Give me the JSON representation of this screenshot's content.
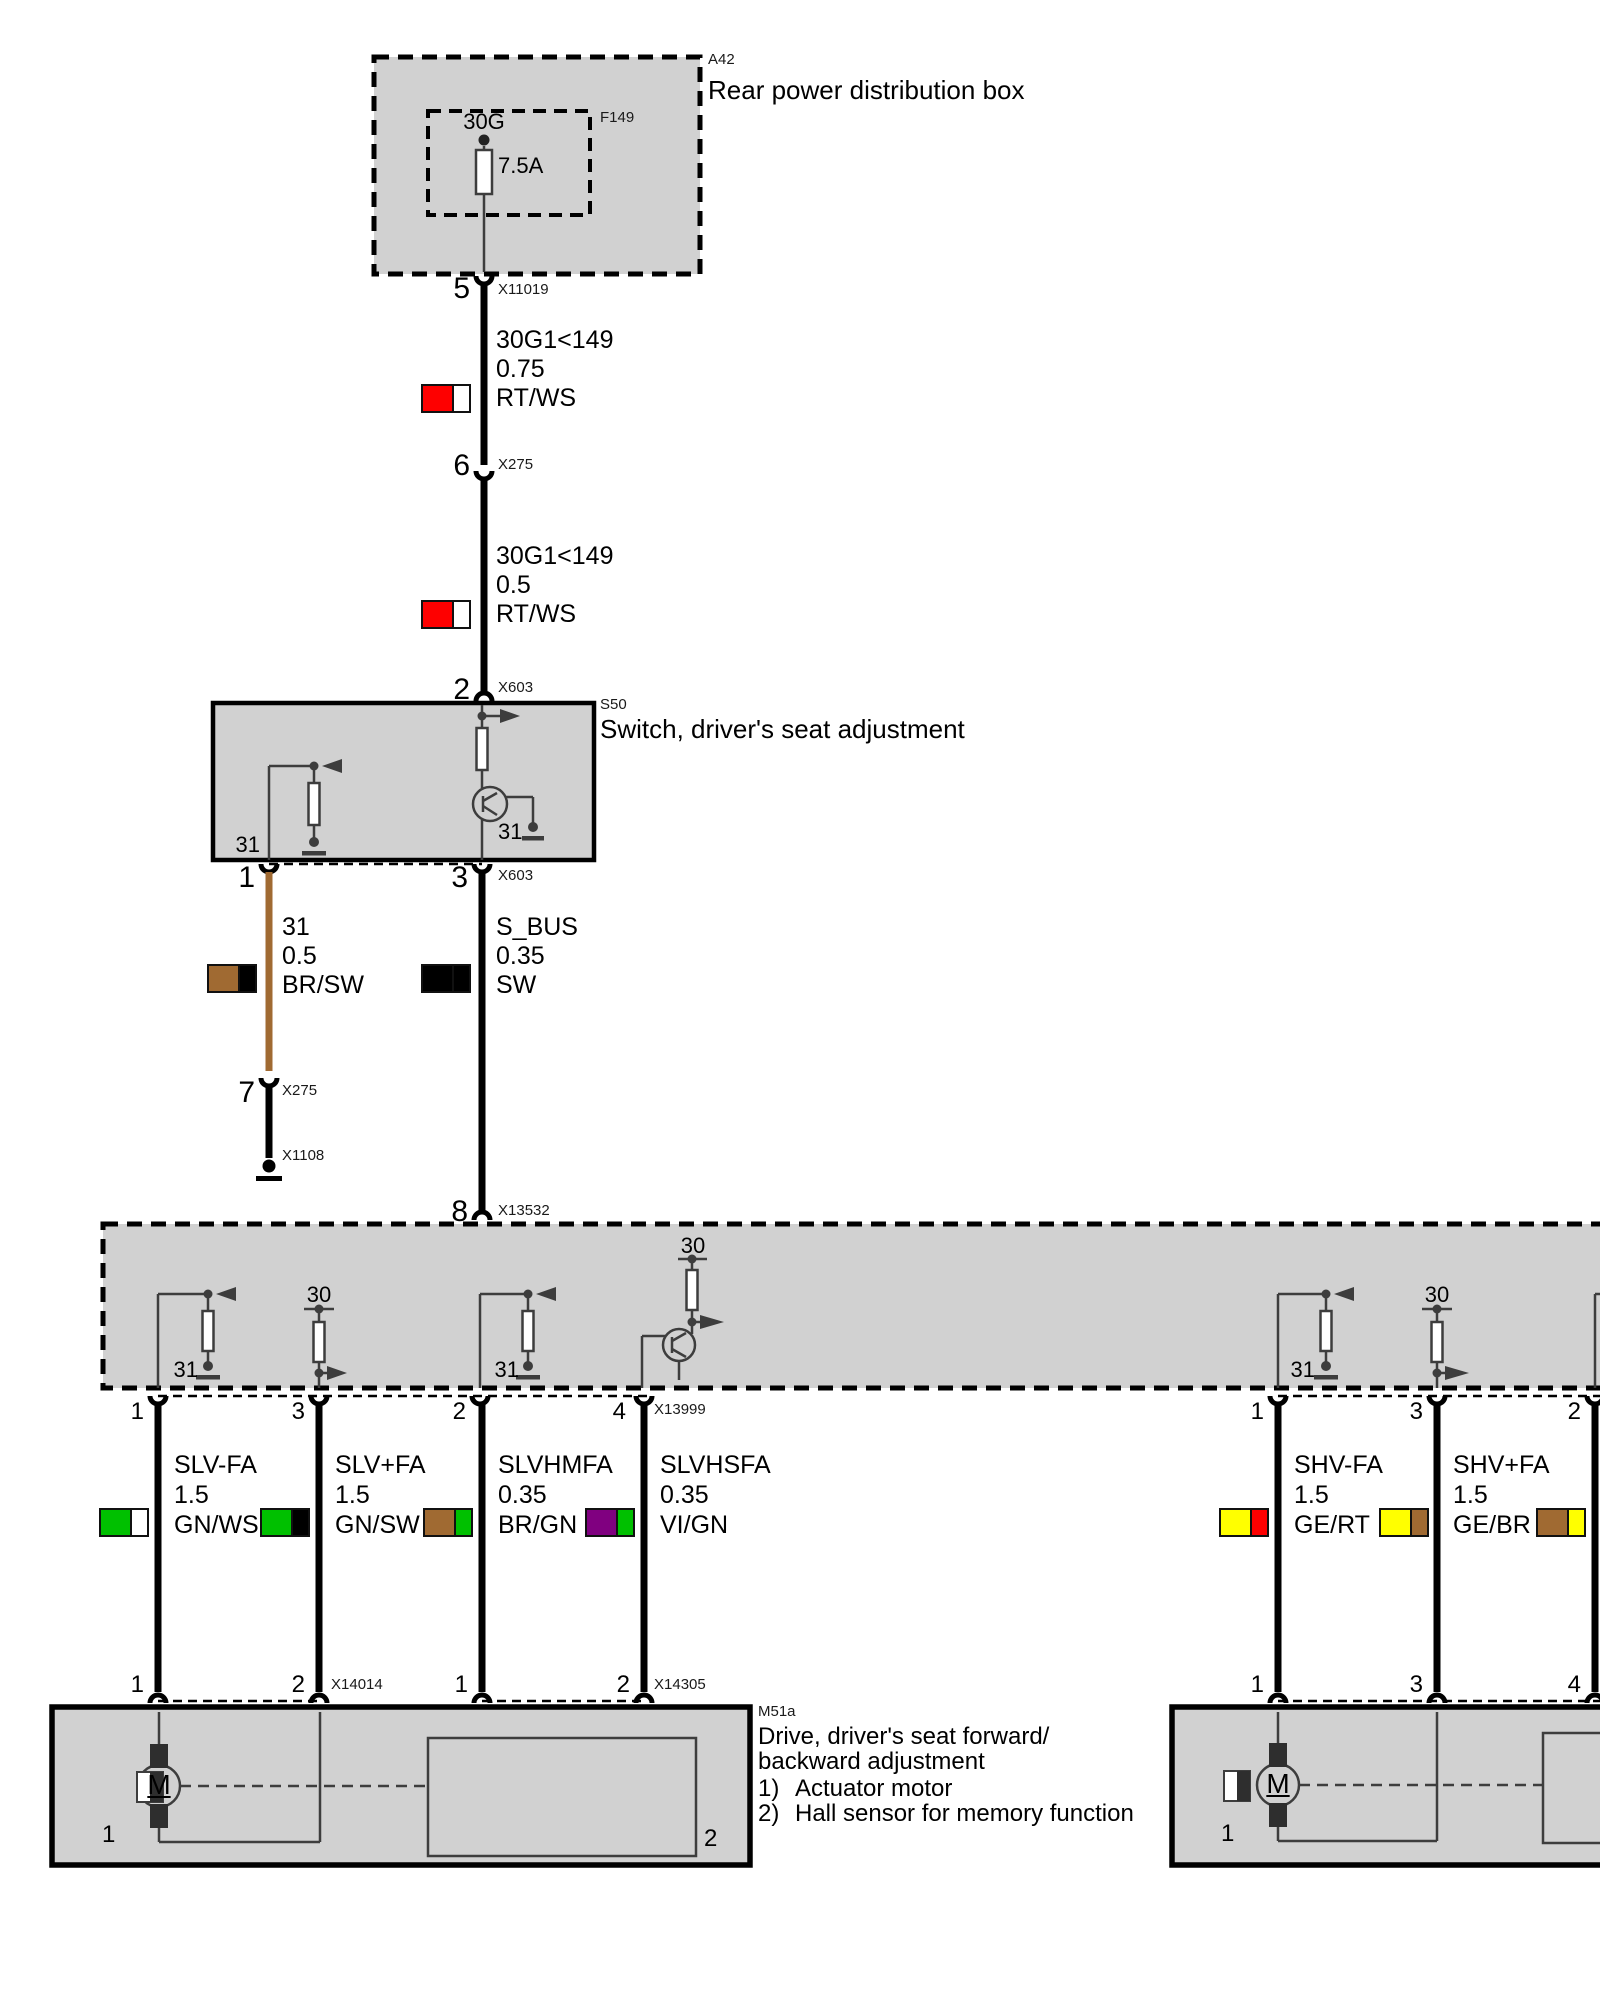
{
  "colors": {
    "box_fill": "#d1d1d1",
    "line_dark": "#3d3d3d",
    "wire_black": "#000000",
    "wire_brown": "#a06a32",
    "red": "#fe0000",
    "white": "#ffffff",
    "green": "#00c000",
    "violet": "#800080",
    "yellow": "#ffff00",
    "black": "#000000"
  },
  "components": {
    "a42": {
      "id": "A42",
      "label": "Rear power distribution box"
    },
    "f149": {
      "id": "F149",
      "fuse_name": "30G",
      "fuse_rating": "7.5A"
    },
    "s50": {
      "id": "S50",
      "label": "Switch, driver's seat adjustment"
    },
    "m51a": {
      "id": "M51a",
      "label_line1": "Drive, driver's seat forward/",
      "label_line2": "backward adjustment",
      "note1_num": "1)",
      "note1_text": "Actuator motor",
      "note2_num": "2)",
      "note2_text": "Hall sensor for memory function"
    },
    "motor_symbol": "M"
  },
  "connectors": {
    "x11019": "X11019",
    "x275": "X275",
    "x603": "X603",
    "x1108": "X1108",
    "x13532": "X13532",
    "x13999": "X13999",
    "x14014": "X14014",
    "x14305": "X14305"
  },
  "internal_labels": {
    "ground": "31",
    "power": "30"
  },
  "pins": {
    "p5": "5",
    "p6": "6",
    "p2": "2",
    "s50_p1": "1",
    "s50_p3": "3",
    "p7": "7",
    "p8": "8",
    "mod_p1": "1",
    "mod_p3": "3",
    "mod_p2": "2",
    "mod_p4": "4",
    "mod_r1": "1",
    "mod_r3": "3",
    "mod_r2": "2",
    "bot_p1": "1",
    "bot_p2": "2",
    "bot_b1": "1",
    "bot_b2": "2",
    "botr_1": "1",
    "botr_3": "3",
    "botr_4": "4",
    "inner_motor": "1",
    "inner_hall": "2",
    "innerR_motor": "1"
  },
  "wires": [
    {
      "circuit": "30G1<149",
      "gauge": "0.75",
      "color": "RT/WS",
      "swatch": [
        "#fe0000",
        "#ffffff"
      ]
    },
    {
      "circuit": "30G1<149",
      "gauge": "0.5",
      "color": "RT/WS",
      "swatch": [
        "#fe0000",
        "#ffffff"
      ]
    },
    {
      "circuit": "31",
      "gauge": "0.5",
      "color": "BR/SW",
      "swatch": [
        "#a06a32",
        "#000000"
      ]
    },
    {
      "circuit": "S_BUS",
      "gauge": "0.35",
      "color": "SW",
      "swatch": [
        "#000000",
        "#000000"
      ]
    },
    {
      "circuit": "SLV-FA",
      "gauge": "1.5",
      "color": "GN/WS",
      "swatch": [
        "#00c000",
        "#ffffff"
      ]
    },
    {
      "circuit": "SLV+FA",
      "gauge": "1.5",
      "color": "GN/SW",
      "swatch": [
        "#00c000",
        "#000000"
      ]
    },
    {
      "circuit": "SLVHMFA",
      "gauge": "0.35",
      "color": "BR/GN",
      "swatch": [
        "#a06a32",
        "#00c000"
      ]
    },
    {
      "circuit": "SLVHSFA",
      "gauge": "0.35",
      "color": "VI/GN",
      "swatch": [
        "#800080",
        "#00c000"
      ]
    },
    {
      "circuit": "SHV-FA",
      "gauge": "1.5",
      "color": "GE/RT",
      "swatch": [
        "#ffff00",
        "#fe0000"
      ]
    },
    {
      "circuit": "SHV+FA",
      "gauge": "1.5",
      "color": "GE/BR",
      "swatch": [
        "#ffff00",
        "#a06a32"
      ]
    },
    {
      "circuit": "",
      "gauge": "",
      "color": "",
      "swatch": [
        "#a06a32",
        "#ffff00"
      ]
    }
  ]
}
